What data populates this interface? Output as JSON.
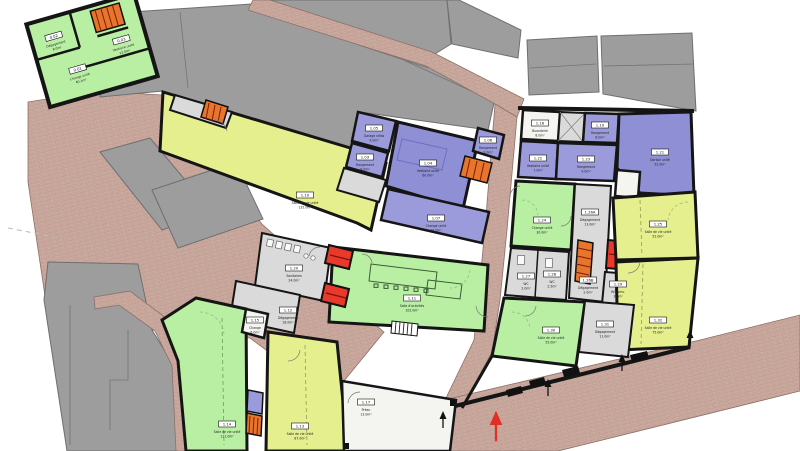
{
  "plan": {
    "type": "architectural-floor-plan",
    "colors": {
      "room_green": "#b9efa3",
      "room_yellow": "#e6ef8e",
      "room_blue": "#9b9bdc",
      "room_blue_dark": "#8f8fd6",
      "corridor_gray": "#dadada",
      "neighbor_gray": "#9d9d9d",
      "paving_brick": "#cbaaa0",
      "wall_black": "#151515",
      "elevator_red": "#e8392b",
      "stair_orange": "#e8752c",
      "entrance_arrow_black": "#111111",
      "entrance_arrow_red": "#e03025"
    },
    "features": {
      "elevator_count": 3,
      "staircase_count": 5
    },
    "rooms": [
      {
        "number": "0.01",
        "name": "Change unité",
        "area": "40.1m²",
        "x": -20,
        "y": 14,
        "layer": "detached"
      },
      {
        "number": "0.02",
        "name": "Dégagement",
        "area": "8.0m²",
        "x": -34,
        "y": -24,
        "layer": "detached"
      },
      {
        "number": "0.03",
        "name": "Vestiaire unité",
        "area": "12.0m²",
        "x": 30,
        "y": -2,
        "layer": "detached"
      },
      {
        "number": "1.10",
        "name": "Salle de vie unité",
        "area": "135.0m²",
        "x": 305,
        "y": 195
      },
      {
        "number": "1.05",
        "name": "Garage vélos",
        "area": "9.0m²",
        "x": 374,
        "y": 128
      },
      {
        "number": "1.03",
        "name": "Rangement",
        "area": "8.0m²",
        "x": 365,
        "y": 157
      },
      {
        "number": "1.04",
        "name": "Vestiaire unité",
        "area": "60.0m²",
        "x": 428,
        "y": 163
      },
      {
        "number": "1.06",
        "name": "Rangement",
        "area": "9.0m²",
        "x": 488,
        "y": 140
      },
      {
        "number": "1.07",
        "name": "Change unité",
        "area": "26.0m²",
        "x": 436,
        "y": 218
      },
      {
        "number": "1.20",
        "name": "Sanitaires",
        "area": "24.0m²",
        "x": 294,
        "y": 268
      },
      {
        "number": "1.12",
        "name": "Dégagement",
        "area": "18.0m²",
        "x": 288,
        "y": 310
      },
      {
        "number": "1.11",
        "name": "Salle d'activités",
        "area": "102.0m²",
        "x": 412,
        "y": 298
      },
      {
        "number": "1.15",
        "name": "Change",
        "area": "6.0m²",
        "x": 255,
        "y": 320
      },
      {
        "number": "1.14",
        "name": "Salle de vie unité",
        "area": "111.0m²",
        "x": 227,
        "y": 424
      },
      {
        "number": "1.13",
        "name": "Salle de vie unité",
        "area": "87.0m²",
        "x": 300,
        "y": 426
      },
      {
        "number": "1.17",
        "name": "Préau",
        "area": "13.0m²",
        "x": 366,
        "y": 402
      },
      {
        "number": "1.16",
        "name": "Buanderie",
        "area": "8.0m²",
        "x": 540,
        "y": 123
      },
      {
        "number": "1.19",
        "name": "Rangement",
        "area": "8.0m²",
        "x": 600,
        "y": 125
      },
      {
        "number": "1.21",
        "name": "Dortoir unité",
        "area": "52.0m²",
        "x": 660,
        "y": 152
      },
      {
        "number": "1.22",
        "name": "Vestiaire unité",
        "area": "7.0m²",
        "x": 538,
        "y": 158
      },
      {
        "number": "1.23",
        "name": "Rangement",
        "area": "9.0m²",
        "x": 586,
        "y": 159
      },
      {
        "number": "1.24",
        "name": "Change unité",
        "area": "30.0m²",
        "x": 542,
        "y": 220
      },
      {
        "number": "1.26A",
        "name": "Dégagement",
        "area": "13.0m²",
        "x": 590,
        "y": 212
      },
      {
        "number": "1.25",
        "name": "Salle de vie unité",
        "area": "52.0m²",
        "x": 658,
        "y": 224
      },
      {
        "number": "1.27",
        "name": "WC",
        "area": "2.0m²",
        "x": 526,
        "y": 276
      },
      {
        "number": "1.28",
        "name": "WC",
        "area": "2.5m²",
        "x": 552,
        "y": 274
      },
      {
        "number": "1.26B",
        "name": "Dégagement",
        "area": "2.0m²",
        "x": 588,
        "y": 280
      },
      {
        "number": "1.29",
        "name": "WC pers.",
        "area": "3.0m²",
        "x": 618,
        "y": 284
      },
      {
        "number": "1.30",
        "name": "Salle de vie unité",
        "area": "55.0m²",
        "x": 551,
        "y": 330
      },
      {
        "number": "1.31",
        "name": "Dégagement",
        "area": "11.0m²",
        "x": 605,
        "y": 324
      },
      {
        "number": "1.32",
        "name": "Salle de vie unité",
        "area": "75.0m²",
        "x": 658,
        "y": 320
      }
    ],
    "entrances": {
      "black_arrows": [
        [
          443,
          414
        ],
        [
          548,
          382
        ],
        [
          622,
          357
        ],
        [
          690,
          333
        ]
      ],
      "red_arrow": [
        496,
        416
      ]
    }
  }
}
